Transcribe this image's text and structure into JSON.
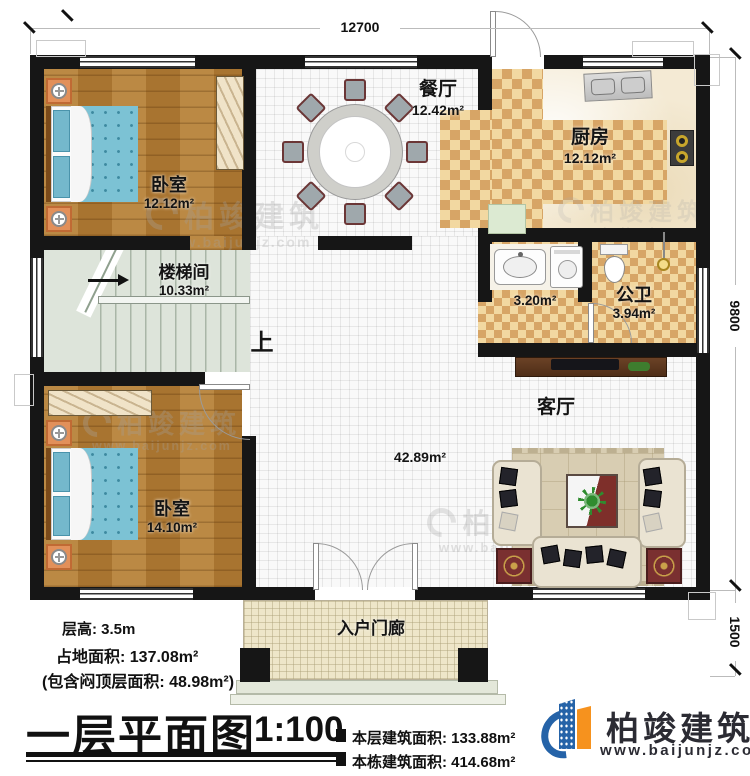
{
  "dimensions": {
    "top": "12700",
    "right": "9800",
    "bottom_right": "1500"
  },
  "rooms": {
    "bedroom1": {
      "name": "卧室",
      "area": "12.12m²"
    },
    "dining": {
      "name": "餐厅",
      "area": "12.42m²"
    },
    "kitchen": {
      "name": "厨房",
      "area": "12.12m²"
    },
    "washroom": {
      "area": "3.20m²"
    },
    "toilet": {
      "name": "公卫",
      "area": "3.94m²"
    },
    "stairwell": {
      "name": "楼梯间",
      "area": "10.33m²",
      "direction": "上"
    },
    "bedroom2": {
      "name": "卧室",
      "area": "14.10m²"
    },
    "living": {
      "name": "客厅",
      "area": "42.89m²"
    },
    "porch": {
      "name": "入户门廊"
    }
  },
  "info": {
    "floor_height": "层高: 3.5m",
    "land_area": "占地面积: 137.08m²",
    "attic_note": "(包含闷顶层面积: 48.98m²)",
    "floor_building_area": "本层建筑面积: 133.88m²",
    "total_building_area": "本栋建筑面积: 414.68m²"
  },
  "title": {
    "text": "一层平面图",
    "scale": "1:100"
  },
  "brand": {
    "name": "柏竣建筑",
    "url": "www.baijunjz.com"
  },
  "watermark": {
    "name": "柏竣建筑",
    "url": "www.baijunjz.com"
  },
  "colors": {
    "wall": "#161616",
    "brand_blue": "#2563a8",
    "brand_orange": "#f6921e",
    "wood_floor": "#b07a33",
    "checker_tile": "#d7a566",
    "bed_blue": "#7cc2d4"
  }
}
